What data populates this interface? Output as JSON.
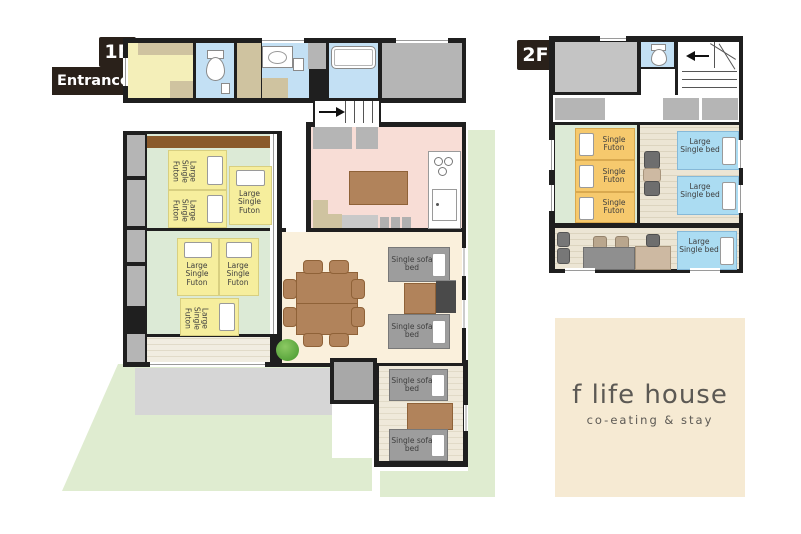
{
  "floor1": {
    "label": "1F",
    "entrance": "Entrance",
    "futon_labels": [
      "Large Single Futon",
      "Large Single Futon",
      "Large Single Futon",
      "Large Single Futon",
      "Large Single Futon",
      "Large Single Futon"
    ],
    "sofa_bed_labels": [
      "Single sofa bed",
      "Single sofa bed",
      "Single sofa bed",
      "Single sofa bed"
    ]
  },
  "floor2": {
    "label": "2F",
    "futon_labels": [
      "Single Futon",
      "Single Futon",
      "Single Futon"
    ],
    "bed_labels": [
      "Large Single bed",
      "Large Single bed",
      "Large Single bed"
    ]
  },
  "logo": {
    "title": "f life house",
    "subtitle": "co-eating & stay"
  },
  "colors": {
    "wall": "#1f1f1f",
    "label_bg": "#2a211a",
    "tatami_green": "#dcead6",
    "futon_yellow": "#f6ee9d",
    "futon_orange": "#f6c96d",
    "bed_blue": "#abdcf2",
    "kitchen_pink": "#f8ddd6",
    "dining_cream": "#faf0dc",
    "bathroom_blue": "#c3e0f4",
    "entrance_yellow": "#f4efb9",
    "lawn_green": "#dfecd0",
    "terrace_gray": "#d6d6d6",
    "wood_floor": "#ece5d4",
    "furniture_brown": "#b1835b",
    "sofa_gray": "#9d9d9d",
    "logo_bg": "#f6ead3",
    "logo_text": "#5c5954"
  }
}
